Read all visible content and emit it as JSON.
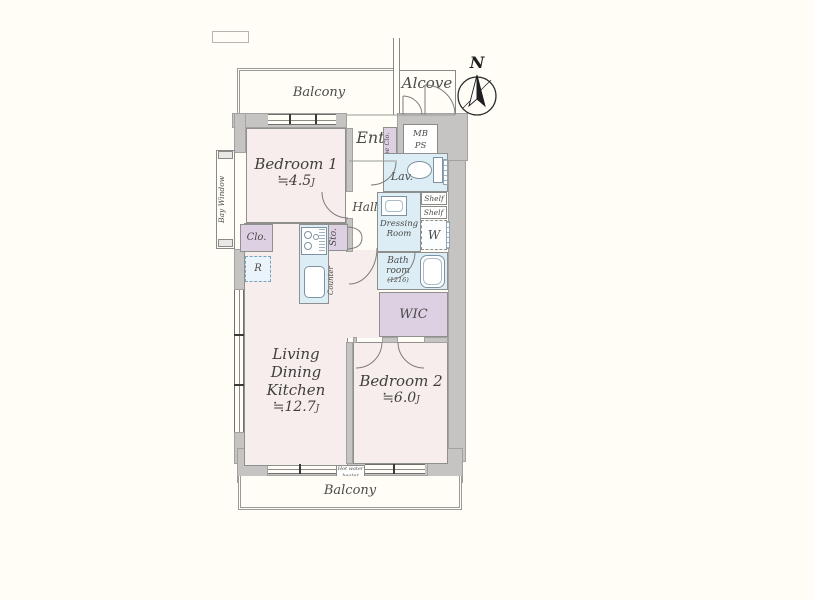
{
  "colors": {
    "wall": "#c6c4c2",
    "room_pink": "#f7edec",
    "wet_blue": "#ddedf6",
    "closet_purple": "#ddd0e3",
    "line_gray": "#8a8a8a"
  },
  "compass": {
    "north": "N"
  },
  "outdoor": {
    "balcony_top": "Balcony",
    "alcove": "Alcove",
    "balcony_bottom": "Balcony",
    "water_heater_line1": "Hot water",
    "water_heater_line2": "heater"
  },
  "entrance": {
    "label": "Ent.",
    "shoe_closet": "Shoe Clo.",
    "mb": "MB",
    "ps": "PS"
  },
  "rooms": {
    "bedroom1": {
      "name": "Bedroom 1",
      "size": "≒4.5",
      "unit": "J"
    },
    "bedroom2": {
      "name": "Bedroom 2",
      "size": "≒6.0",
      "unit": "J"
    },
    "ldk": {
      "name_line1": "Living Dining",
      "name_line2": "Kitchen",
      "size": "≒12.7",
      "unit": "J"
    },
    "hall": "Hall",
    "lavatory": "Lav.",
    "dressing_line1": "Dressing",
    "dressing_line2": "Room",
    "bath_line1": "Bath",
    "bath_line2": "room",
    "bath_size": "(1216)",
    "wic": "WIC"
  },
  "fixtures": {
    "bay_window": "Bay Window",
    "closet": "Clo.",
    "refrigerator": "R",
    "storage": "Sto.",
    "counter": "Counter",
    "shelf_upper": "Shelf",
    "shelf_lower": "Shelf",
    "washer": "W"
  }
}
